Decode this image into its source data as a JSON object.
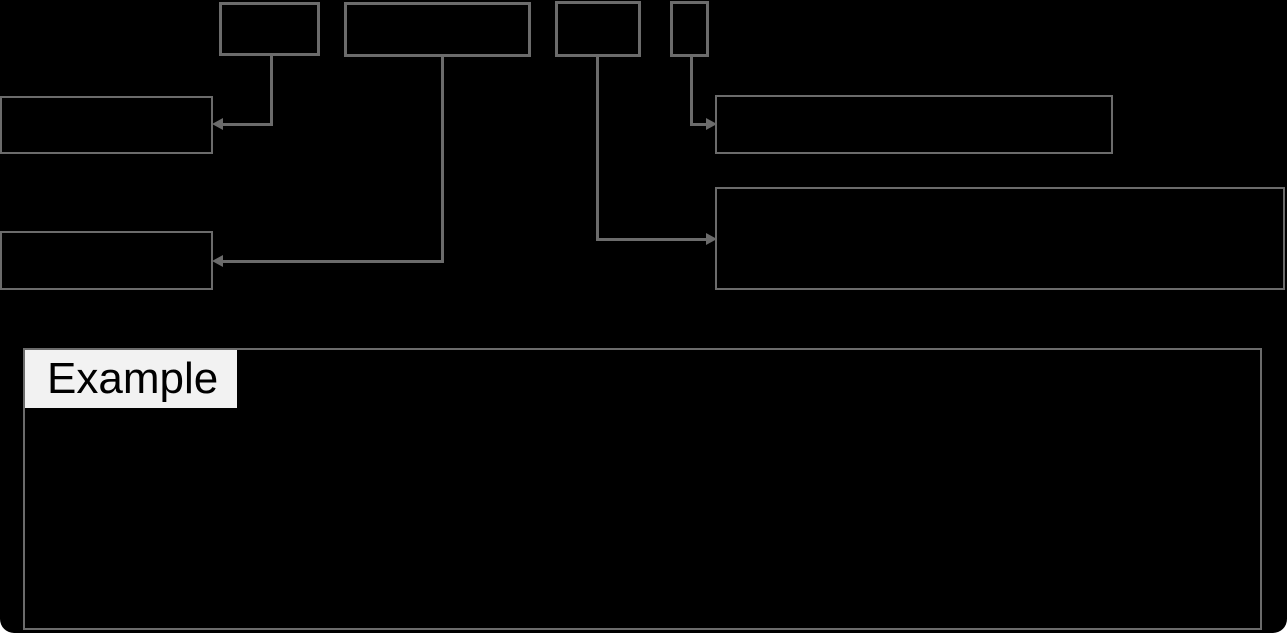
{
  "page": {
    "background": "#000000",
    "width": 1287,
    "height": 633
  },
  "colors": {
    "line": "#6b6b6b",
    "example_label_background": "#f2f2f2",
    "example_label_text": "#000000"
  },
  "example_section": {
    "label": "Example"
  },
  "diagram": {
    "source_boxes": [
      {
        "name": "token-box-1",
        "text": ""
      },
      {
        "name": "token-box-2",
        "text": ""
      },
      {
        "name": "token-box-3",
        "text": ""
      },
      {
        "name": "token-box-4",
        "text": ""
      }
    ],
    "annotation_boxes": [
      {
        "name": "annotation-box-top-left",
        "text": ""
      },
      {
        "name": "annotation-box-bottom-left",
        "text": ""
      },
      {
        "name": "annotation-box-top-right",
        "text": ""
      },
      {
        "name": "annotation-box-bottom-right",
        "text": ""
      }
    ],
    "connectors": [
      {
        "from": "token-box-1",
        "to": "annotation-box-top-left",
        "arrow_direction": "left"
      },
      {
        "from": "token-box-2",
        "to": "annotation-box-bottom-left",
        "arrow_direction": "left"
      },
      {
        "from": "token-box-3",
        "to": "annotation-box-bottom-right",
        "arrow_direction": "right"
      },
      {
        "from": "token-box-4",
        "to": "annotation-box-top-right",
        "arrow_direction": "right"
      }
    ]
  }
}
